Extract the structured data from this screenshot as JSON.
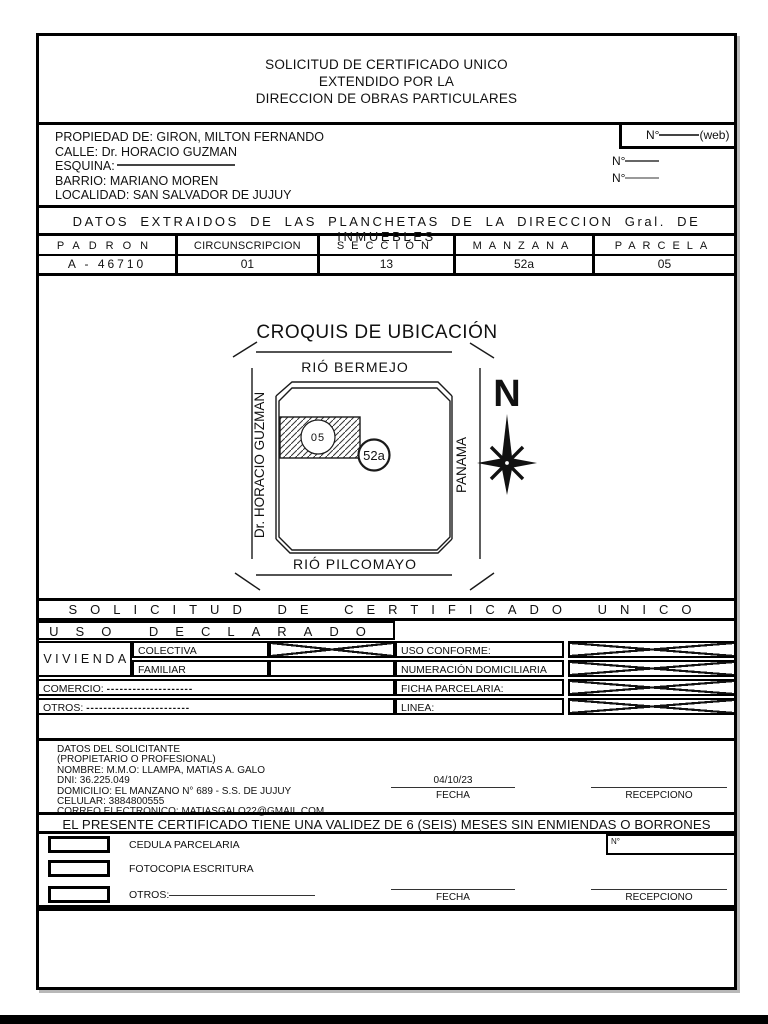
{
  "form": {
    "header": {
      "lines": [
        "SOLICITUD DE CERTIFICADO UNICO",
        "EXTENDIDO POR LA",
        "DIRECCION DE OBRAS PARTICULARES"
      ]
    },
    "property": {
      "propiedad_label": "PROPIEDAD DE:",
      "propiedad_value": "GIRON, MILTON FERNANDO",
      "calle_label": "CALLE:",
      "calle_value": "Dr. HORACIO GUZMAN",
      "esquina_label": "ESQUINA:",
      "barrio_label": "BARRIO:",
      "barrio_value": "MARIANO MOREN",
      "localidad_label": "LOCALIDAD:",
      "localidad_value": "SAN SALVADOR DE JUJUY",
      "numero_label": "N°",
      "numero_web_suffix": "(web)",
      "numero2_label": "N°",
      "numero3_label": "N°"
    },
    "cadastral": {
      "band": "DATOS EXTRAIDOS DE LAS PLANCHETAS DE LA DIRECCION Gral. DE INMUEBLES",
      "headers": [
        "PADRON",
        "CIRCUNSCRIPCION",
        "SECCIÓN",
        "MANZANA",
        "PARCELA"
      ],
      "values": [
        "A - 46710",
        "01",
        "13",
        "52a",
        "05"
      ]
    },
    "croquis": {
      "title": "CROQUIS DE UBICACIÓN",
      "street_top": "RIÓ BERMEJO",
      "street_bottom": "RIÓ PILCOMAYO",
      "street_left": "Dr. HORACIO GUZMAN",
      "street_right": "PANAMA",
      "parcel_label": "05",
      "block_label": "52a",
      "compass_label": "N"
    },
    "bands": {
      "solicitud": "SOLICITUD DE CERTIFICADO UNICO",
      "uso_declarado": "USO DECLARADO",
      "validez": "EL PRESENTE CERTIFICADO TIENE UNA VALIDEZ DE 6 (SEIS) MESES SIN ENMIENDAS O BORRONES"
    },
    "uso": {
      "vivienda": "VIVIENDA",
      "colectiva": "COLECTIVA",
      "familiar": "FAMILIAR",
      "comercio_label": "COMERCIO:",
      "comercio_dots": "--------------------",
      "otros_label": "OTROS:",
      "otros_dots": "------------------------",
      "uso_conforme": "USO CONFORME:",
      "numeracion": "NUMERACIÓN DOMICILIARIA",
      "ficha": "FICHA PARCELARIA:",
      "linea": "LINEA:",
      "checks": {
        "colectiva": true,
        "familiar": false,
        "uso_conforme": true,
        "numeracion": true,
        "ficha": true,
        "linea": true
      }
    },
    "solicitante": {
      "title": "DATOS DEL SOLICITANTE",
      "subtitle": "(PROPIETARIO O PROFESIONAL)",
      "nombre": "NOMBRE: M.M.O: LLAMPA, MATIAS A. GALO",
      "dni": "DNI: 36.225.049",
      "domicilio": "DOMICILIO: EL MANZANO N° 689 - S.S. DE JUJUY",
      "celular": "CELULAR: 3884800555",
      "correo": "CORREO ELECTRONICO: MATIASGALO22@GMAIL.COM",
      "fecha_value": "04/10/23",
      "fecha_label": "FECHA",
      "recepciono_label": "RECEPCIONO"
    },
    "documents": {
      "cedula": "CEDULA PARCELARIA",
      "fotocopia": "FOTOCOPIA ESCRITURA",
      "otros_label": "OTROS:",
      "numero_label": "N°",
      "fecha_label": "FECHA",
      "recepciono_label": "RECEPCIONO"
    }
  }
}
